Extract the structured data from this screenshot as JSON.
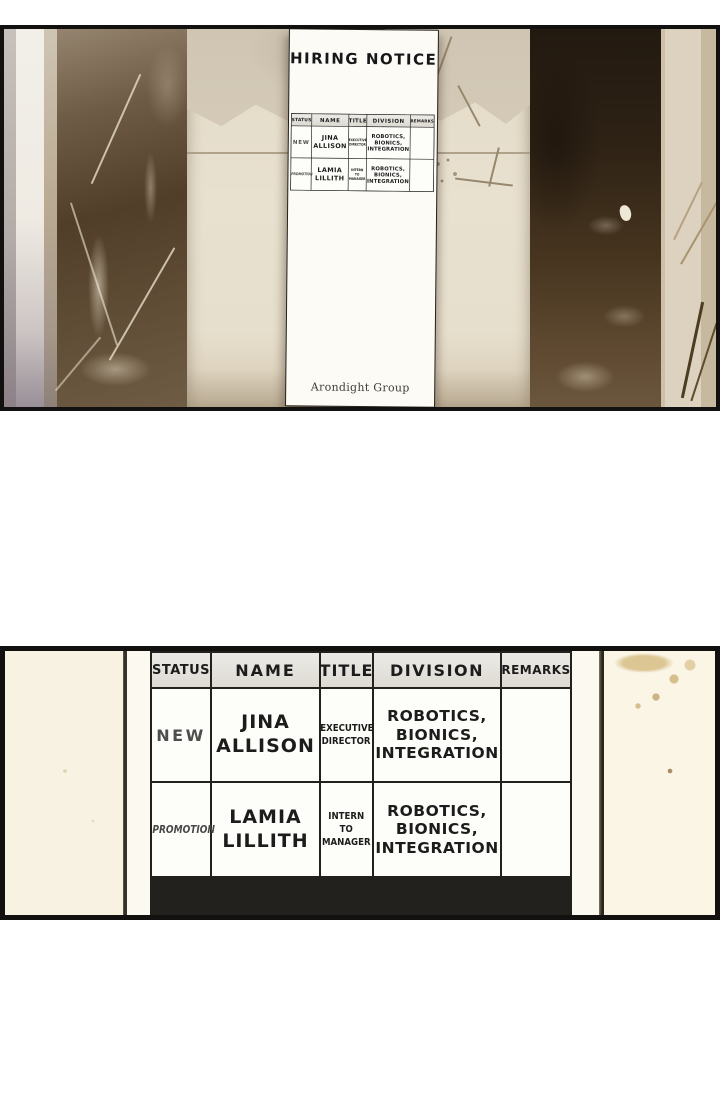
{
  "scene": {
    "floor_number": "2"
  },
  "notice_paper": {
    "title": "HIRING NOTICE",
    "signature": "Arondight Group"
  },
  "hiring_table": {
    "headers": {
      "status": "STATUS",
      "name": "NAME",
      "title": "TITLE",
      "division": "DIVISION",
      "remarks": "REMARKS"
    },
    "rows": [
      {
        "status": "NEW",
        "name": "JINA ALLISON",
        "title": "EXECUTIVE DIRECTOR",
        "division": "ROBOTICS, BIONICS, INTEGRATION",
        "remarks": ""
      },
      {
        "status": "PROMOTION",
        "name": "LAMIA LILLITH",
        "title": "INTERN TO MANAGER",
        "division": "ROBOTICS, BIONICS, INTEGRATION",
        "remarks": ""
      }
    ]
  },
  "colors": {
    "panel_border": "#121110",
    "wall_cream": "#e7dfcd",
    "marble_dark": "#46341f",
    "paper_white": "#fcfbf6",
    "table_header_bg": "#e5e2dc",
    "bottom_panel_bg": "#fcf9f0"
  }
}
